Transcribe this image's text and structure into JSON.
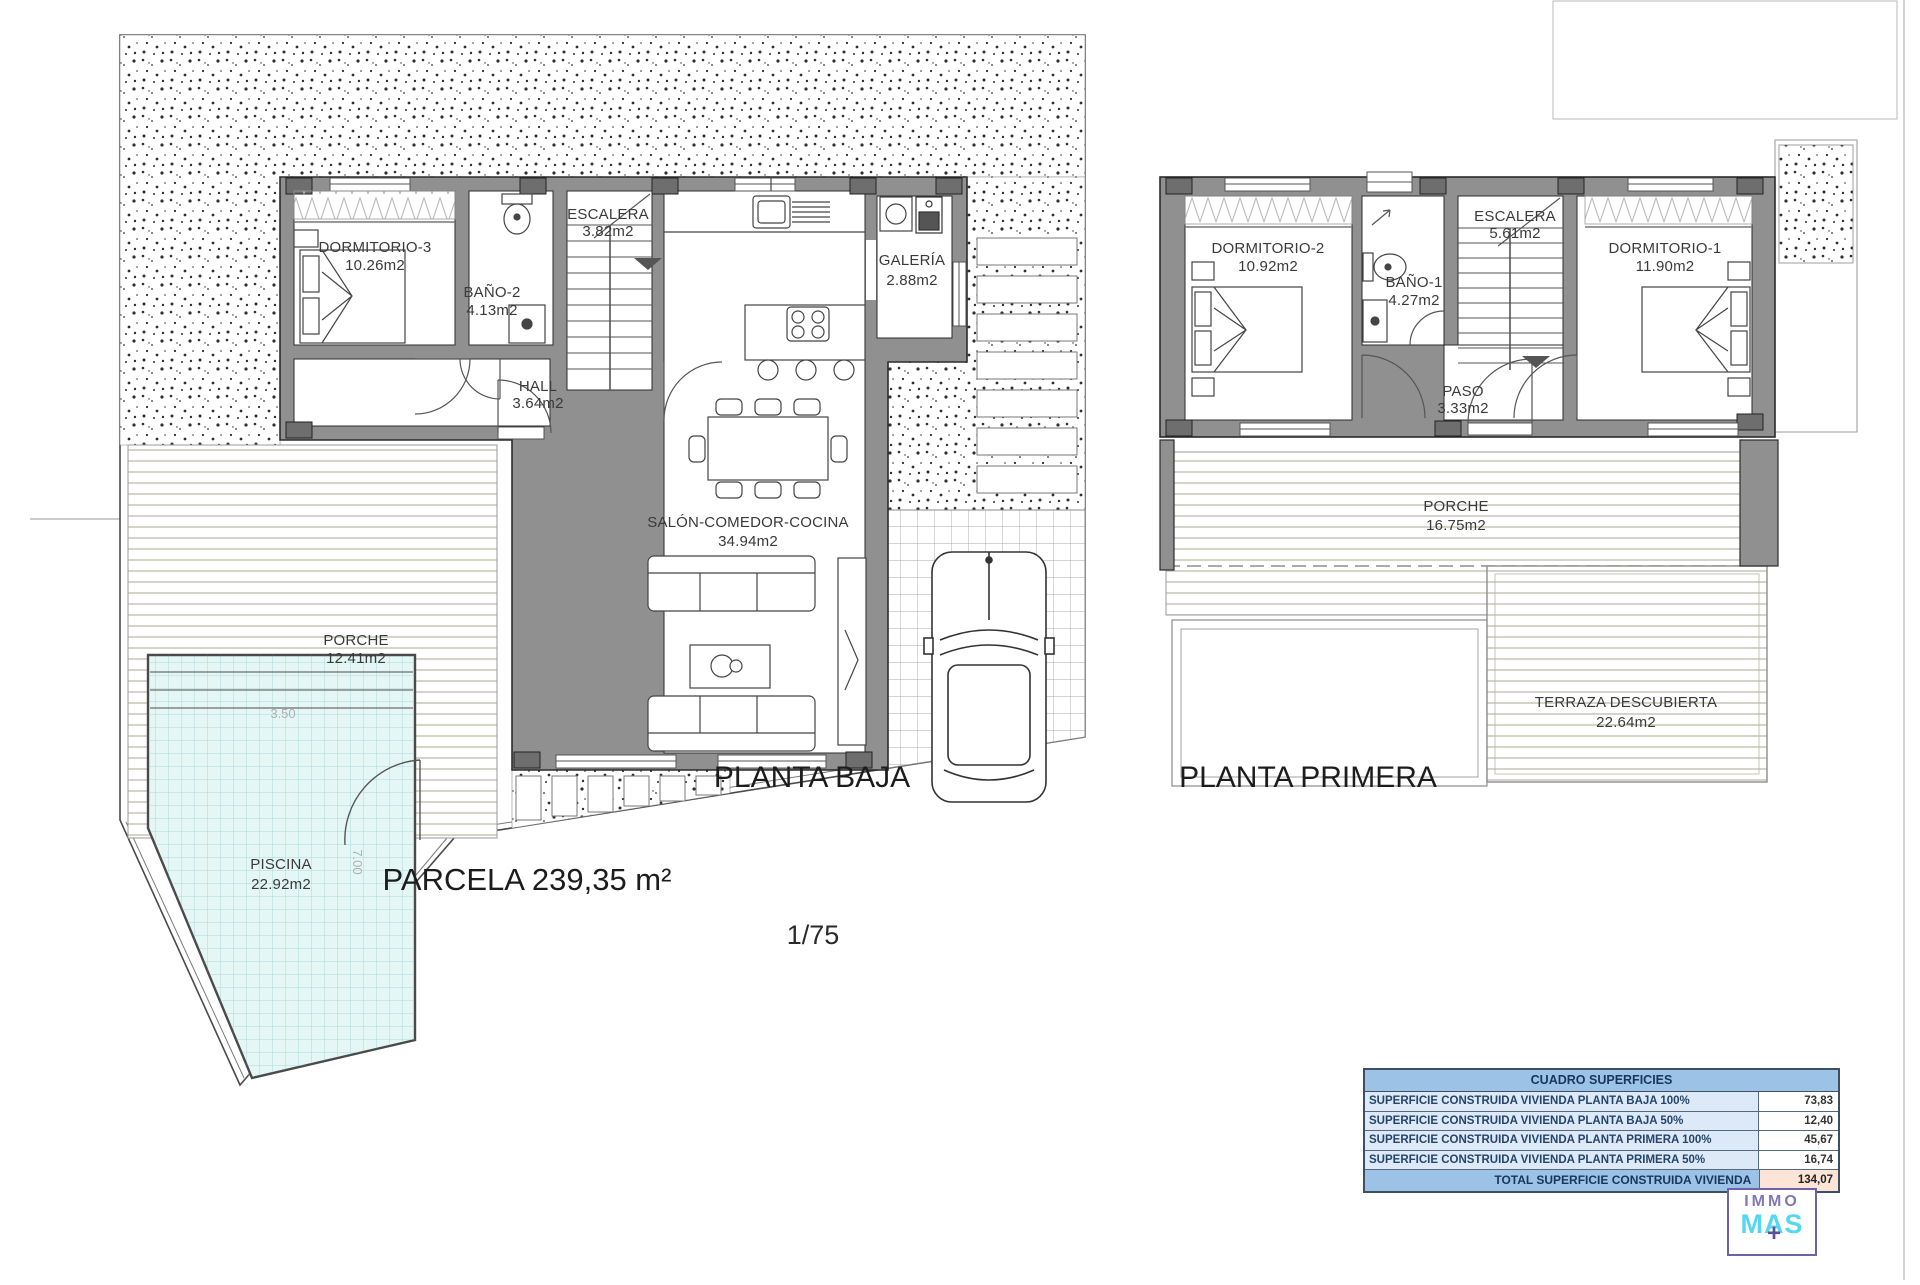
{
  "titles": {
    "ground_floor": "PLANTA BAJA",
    "first_floor": "PLANTA PRIMERA",
    "parcel": "PARCELA 239,35 m²",
    "drawing_scale": "1/75"
  },
  "ground_floor": {
    "dormitorio3": {
      "name": "DORMITORIO-3",
      "area": "10.26m2"
    },
    "bano2": {
      "name": "BAÑO-2",
      "area": "4.13m2"
    },
    "escalera": {
      "name": "ESCALERA",
      "area": "3.82m2"
    },
    "galeria": {
      "name": "GALERÍA",
      "area": "2.88m2"
    },
    "hall": {
      "name": "HALL",
      "area": "3.64m2"
    },
    "salon": {
      "name": "SALÓN-COMEDOR-COCINA",
      "area": "34.94m2"
    },
    "porche": {
      "name": "PORCHE",
      "area": "12.41m2"
    },
    "piscina": {
      "name": "PISCINA",
      "area": "22.92m2"
    },
    "pool_width": "3.50",
    "pool_length": "7.00"
  },
  "first_floor": {
    "dormitorio2": {
      "name": "DORMITORIO-2",
      "area": "10.92m2"
    },
    "bano1": {
      "name": "BAÑO-1",
      "area": "4.27m2"
    },
    "escalera": {
      "name": "ESCALERA",
      "area": "5.61m2"
    },
    "paso": {
      "name": "PASO",
      "area": "3.33m2"
    },
    "dormitorio1": {
      "name": "DORMITORIO-1",
      "area": "11.90m2"
    },
    "porche": {
      "name": "PORCHE",
      "area": "16.75m2"
    },
    "terraza": {
      "name": "TERRAZA DESCUBIERTA",
      "area": "22.64m2"
    }
  },
  "areas_table": {
    "title": "CUADRO SUPERFICIES",
    "rows": [
      {
        "label": "SUPERFICIE CONSTRUIDA VIVIENDA PLANTA BAJA 100%",
        "value": "73,83"
      },
      {
        "label": "SUPERFICIE CONSTRUIDA VIVIENDA PLANTA BAJA 50%",
        "value": "12,40"
      },
      {
        "label": "SUPERFICIE CONSTRUIDA VIVIENDA PLANTA PRIMERA 100%",
        "value": "45,67"
      },
      {
        "label": "SUPERFICIE CONSTRUIDA VIVIENDA PLANTA PRIMERA 50%",
        "value": "16,74"
      }
    ],
    "total_label": "TOTAL SUPERFICIE CONSTRUIDA VIVIENDA",
    "total_value": "134,07"
  },
  "logo": {
    "top": "IMMO",
    "bottom": "MAS",
    "plus": "+"
  },
  "colors": {
    "wall": "#909090",
    "pool": "#e4f7f5",
    "table_header": "#9cc3e5",
    "table_row": "#dde9f6",
    "table_total_value": "#fce4d6",
    "logo_purple": "#6f61a9",
    "logo_cyan": "#55d7f2"
  }
}
